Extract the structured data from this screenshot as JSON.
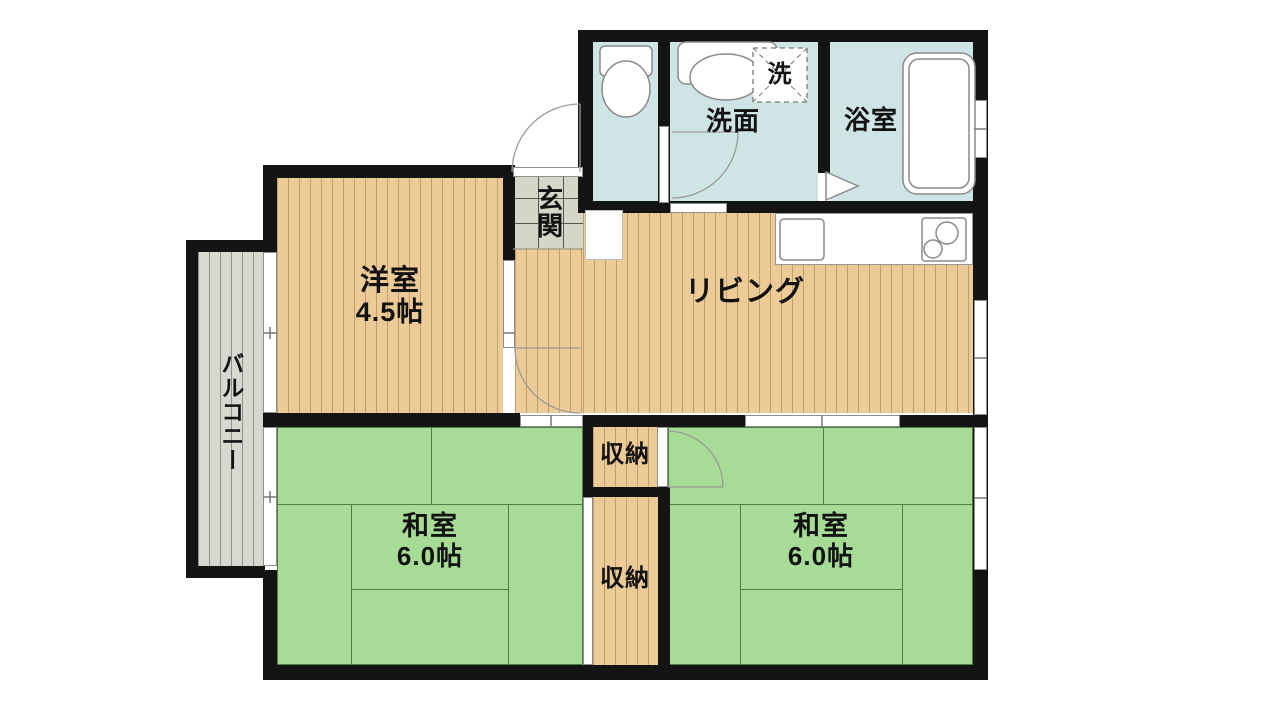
{
  "title": "apartment-floor-plan",
  "rooms": {
    "washroom": {
      "label": "洗面"
    },
    "laundry": {
      "label": "洗"
    },
    "bathroom": {
      "label": "浴室"
    },
    "entrance": {
      "label": "玄関"
    },
    "western_room": {
      "label": "洋室",
      "size": "4.5帖"
    },
    "living": {
      "label": "リビング"
    },
    "balcony": {
      "label": "バルコニー"
    },
    "closet_upper": {
      "label": "収納"
    },
    "closet_lower": {
      "label": "収納"
    },
    "japanese_room_left": {
      "label": "和室",
      "size": "6.0帖"
    },
    "japanese_room_right": {
      "label": "和室",
      "size": "6.0帖"
    }
  },
  "colors": {
    "wall": "#141414",
    "wood_floor": "#EDCB96",
    "wood_stripe": "#C19E6B",
    "tatami": "#A6DC95",
    "tatami_line": "#4E7E46",
    "wet_area": "#CFE5E5",
    "entrance_tile": "#D5D5C8",
    "balcony": "#D8D8D0",
    "balcony_stripe": "#91918A",
    "fixture_line": "#8A8A8A"
  }
}
